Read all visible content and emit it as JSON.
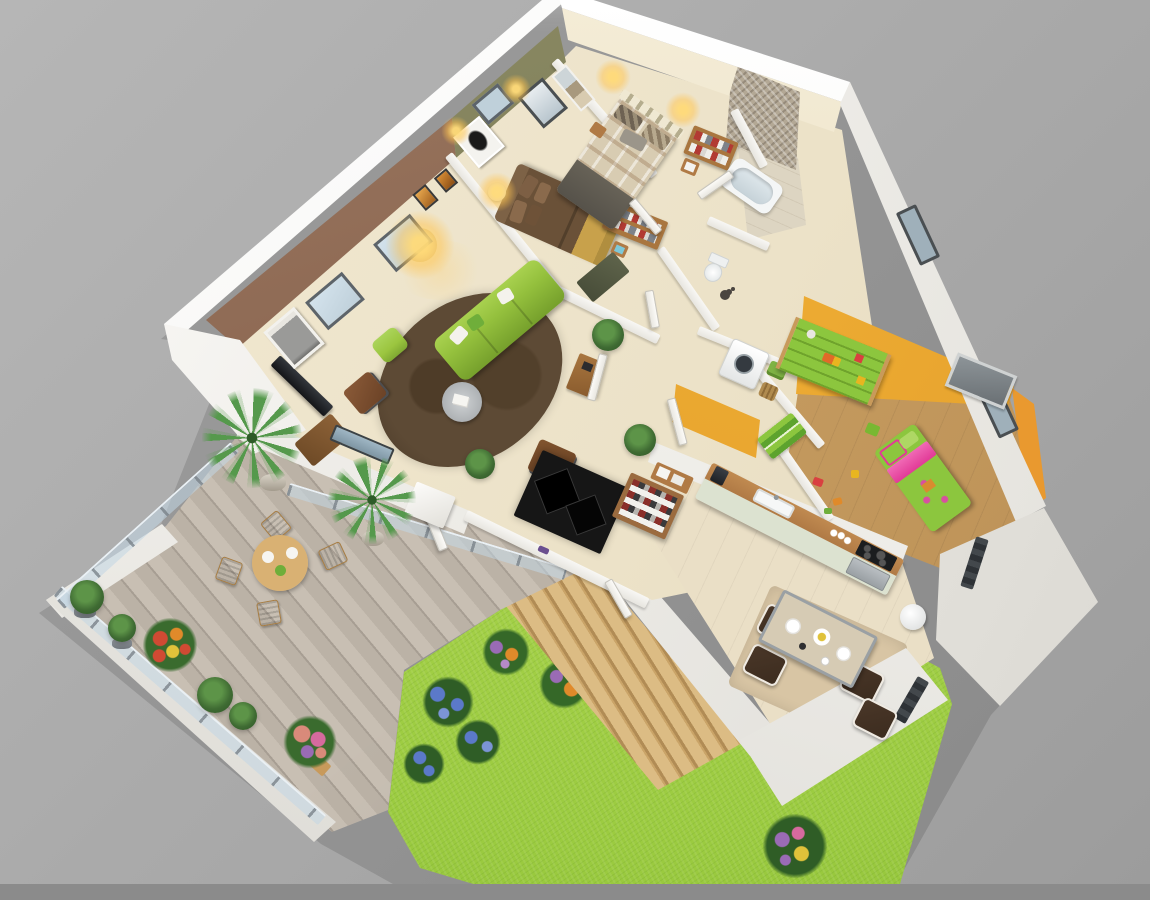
{
  "image": {
    "type": "3d-isometric-floor-plan-render",
    "description": "Dollhouse cutaway view of a three-bedroom apartment with wooden terrace, garden stairs and lawn on a grey studio background",
    "background": "#a8a8a8"
  },
  "palette": {
    "bg": "#a8a8a8",
    "bgLight": "#b6b6b6",
    "bgDark": "#8b8b8b",
    "wallWhite": "#f6f5f2",
    "wallShade": "#e4e2dd",
    "wallDark": "#cfcdc8",
    "floorCream": "#ece2c8",
    "floorKitchen": "#eadfc6",
    "floorDiningTan": "#d8c5a4",
    "floorKids": "#c89e62",
    "bathFloor": "#ddd5c2",
    "accentBrown": "#8a6550",
    "accentOlive": "#7c7b55",
    "accentYellow": "#f2b237",
    "accentOrange": "#e9992f",
    "sofaGreen": "#94c03d",
    "poufGreen": "#9bc53f",
    "kidGreen": "#8cc63e",
    "pinkBed": "#e23a97",
    "rugBrown": "#5d4a35",
    "espresso": "#3c2c1f",
    "woodFurn": "#b07a45",
    "woodLight": "#c89a5b",
    "duvetBrown": "#6a5138",
    "throwTan": "#c8a14b",
    "plaidBase": "#d8ccb2",
    "duvetGrey": "#56524a",
    "headboardCream": "#efe8d2",
    "mosaic": "#b3a895",
    "tubWhite": "#f4f6f6",
    "deckWood": "#c3bab0",
    "deckLine": "#a79e93",
    "parapetWhite": "#f3f2ef",
    "grass": "#9bcb40",
    "grassDark": "#84b32f",
    "stairWood": "#dcbc84",
    "stairShade": "#b18c55",
    "glass": "#c2d6e4",
    "windowPale": "#bfd0da",
    "frameDark": "#4a4f52",
    "glow": "#ffd36a",
    "tvBlack": "#141518",
    "applianceWhite": "#f2f3f3",
    "steel": "#b9bec2",
    "plantGreen": "#3f6b33",
    "palmGreen": "#55994c",
    "flowerRed": "#d04a33",
    "flowerOrange": "#e08a2a",
    "flowerPink": "#d66a9e",
    "flowerBlue": "#5b79c9",
    "flowerPurple": "#9a6bb5",
    "flowerYellow": "#e0c23a"
  },
  "areas": [
    {
      "name": "living-room",
      "floor": "#ece2c8",
      "accent_wall": "#8a6550",
      "items": [
        "green-sofa",
        "green-pouf",
        "brown-rug",
        "round-coffee-table",
        "tv",
        "tv-stand",
        "leather-cube-seat",
        "leather-cube-seat-2",
        "sideboard",
        "floor-lamp",
        "city-photo-art",
        "amber-art",
        "windows",
        "plants"
      ]
    },
    {
      "name": "bedroom-1",
      "floor": "#ece2c8",
      "accent_wall": "#7c7b55",
      "items": [
        "double-bed-brown",
        "drum-lamp",
        "nightstand",
        "open-wardrobe",
        "closet-panel",
        "bw-art",
        "sconces"
      ]
    },
    {
      "name": "bedroom-2",
      "floor": "#ece2c8",
      "accent_wall": "#efe8d2",
      "items": [
        "double-bed-plaid",
        "striped-headboard",
        "nightstands",
        "open-wardrobe",
        "beach-art-panel",
        "sconces",
        "window"
      ]
    },
    {
      "name": "bathroom",
      "floor": "#ddd5c2",
      "items": [
        "mosaic-shower-wall",
        "bathtub",
        "glass-door"
      ]
    },
    {
      "name": "wc",
      "floor": "#ece2c8",
      "items": [
        "toilet",
        "shower-fixture"
      ]
    },
    {
      "name": "laundry",
      "floor": "#ece2c8",
      "items": [
        "washing-machine",
        "green-laundry-tub",
        "wicker-basket"
      ]
    },
    {
      "name": "kids-room",
      "floor": "#c89e62",
      "accent_walls": [
        "#f2b237",
        "#e9992f"
      ],
      "items": [
        "green-single-bed",
        "pink-duvet-fold",
        "toy-shelf",
        "toy-chest",
        "stool",
        "floor-toys",
        "wall-picture"
      ]
    },
    {
      "name": "kitchen",
      "floor": "#eadfc6",
      "items": [
        "counter",
        "sink",
        "coffee-machine",
        "cooktop",
        "oven",
        "cups",
        "trash-bin"
      ]
    },
    {
      "name": "dining",
      "floor": "#d8c5a4",
      "items": [
        "glass-table",
        "plates",
        "espresso-chair",
        "espresso-chair",
        "espresso-chair",
        "espresso-chair"
      ]
    },
    {
      "name": "entry-hall",
      "floor": "#ece2c8",
      "items": [
        "black-diamond-rug",
        "shoe-cabinet",
        "console-with-boxes",
        "purple-shoes",
        "glass-slider",
        "doors"
      ]
    }
  ],
  "outdoor": {
    "terrace": {
      "deck": "#c3bab0",
      "items": [
        "glass-railing",
        "glass-railing",
        "glass-railing",
        "white-parapet",
        "round-table",
        "wooden-chair",
        "wooden-chair",
        "wooden-chair",
        "wooden-chair",
        "palm-tree",
        "palm-tree",
        "boxwood-pots",
        "red-flower-pot",
        "pink-flower-planter",
        "dark-plants",
        "white-pillar"
      ]
    },
    "garden": {
      "lawn": "#9bcb40",
      "items": [
        "wooden-stairs",
        "blue-flower-bed",
        "blue-flower-bed",
        "blue-flower-bed",
        "purple-orange-bed",
        "purple-orange-bed",
        "purple-orange-bed",
        "purple-orange-bed",
        "purple-yellow-bed"
      ]
    },
    "exterior": {
      "walls": "#f6f5f2",
      "items": [
        "window-frame",
        "window-frame",
        "metal-fence",
        "metal-fence"
      ]
    }
  }
}
